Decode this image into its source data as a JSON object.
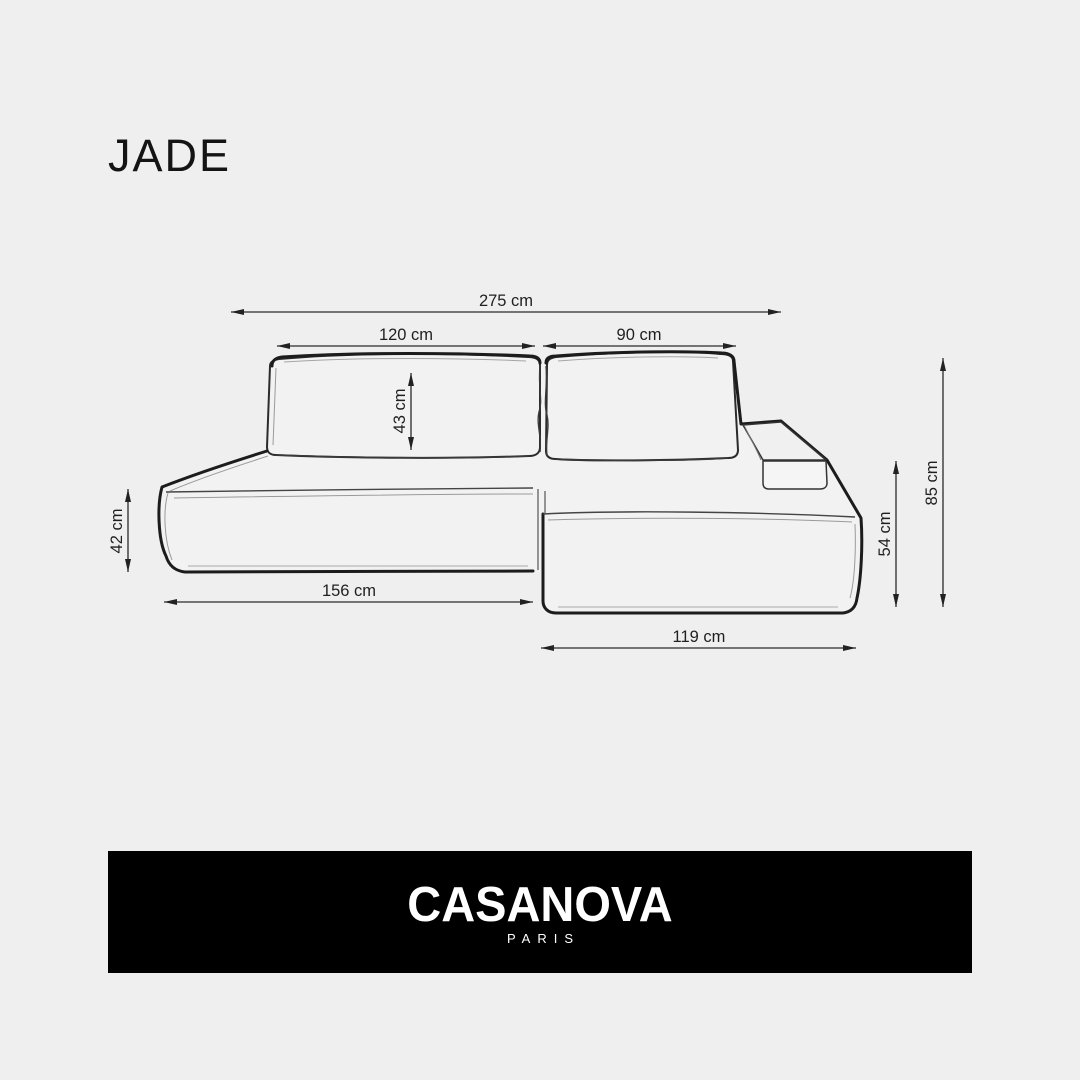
{
  "title": "JADE",
  "colors": {
    "background": "#efefef",
    "line_primary": "#1c1c1c",
    "line_dimension": "#2a2a2a",
    "banner_background": "#000000",
    "banner_text": "#ffffff",
    "title_text": "#141414"
  },
  "diagram": {
    "description": "corner sofa technical dimension drawing",
    "dims": {
      "total_width": "275 cm",
      "left_backrest_width": "120 cm",
      "right_backrest_width": "90 cm",
      "backrest_cushion_height": "43 cm",
      "left_seat_height": "42 cm",
      "left_section_length": "156 cm",
      "chaise_length": "119 cm",
      "right_seat_height": "54 cm",
      "overall_height": "85 cm"
    }
  },
  "footer": {
    "brand": "CASANOVA",
    "city": "PARIS"
  }
}
